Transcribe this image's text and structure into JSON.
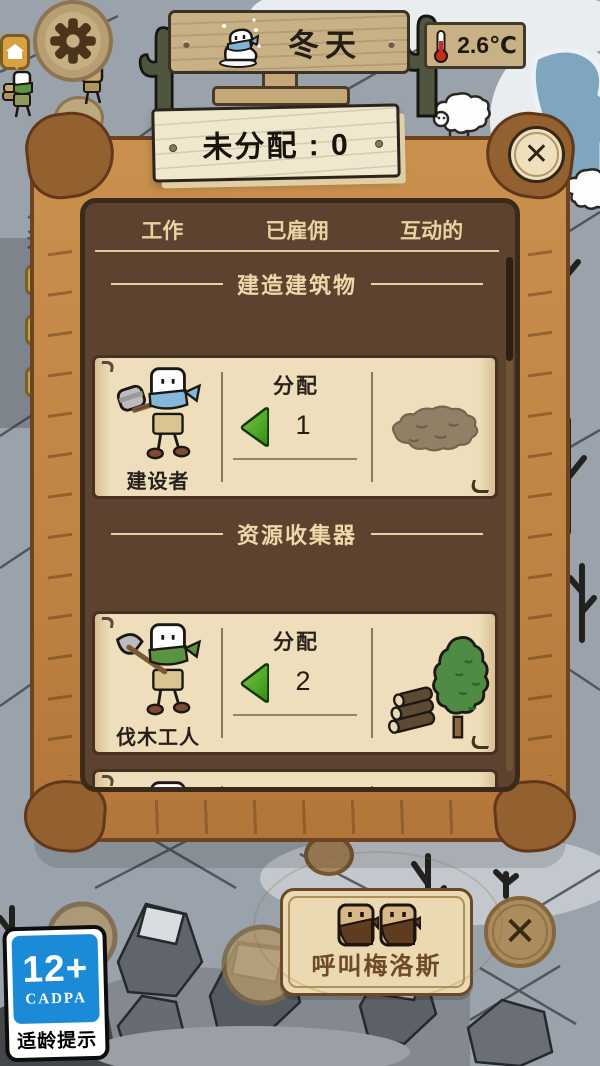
{
  "hud": {
    "season": "冬天",
    "temperature": "2.6℃",
    "side_tag": "通"
  },
  "modal": {
    "title": "未分配 : 0",
    "close_glyph": "✕",
    "tabs": [
      "工作",
      "已雇佣",
      "互动的"
    ],
    "section1": "建造建筑物",
    "section2": "资源收集器",
    "cards": [
      {
        "name": "建设者",
        "assign": "分配",
        "count": "1"
      },
      {
        "name": "伐木工人",
        "assign": "分配",
        "count": "2"
      },
      {
        "name": "",
        "assign": "分配",
        "count": ""
      }
    ]
  },
  "footer": {
    "call_label": "呼叫梅洛斯",
    "close_glyph": "✕"
  },
  "age_rating": {
    "age": "12+",
    "org": "CADPA",
    "caption": "适龄提示"
  },
  "colors": {
    "accent_green": "#3aa322",
    "wood_frame": "#c08443",
    "panel_brown": "#5d4230",
    "parchment": "#eedebb",
    "badge_blue": "#1b8bd8"
  }
}
